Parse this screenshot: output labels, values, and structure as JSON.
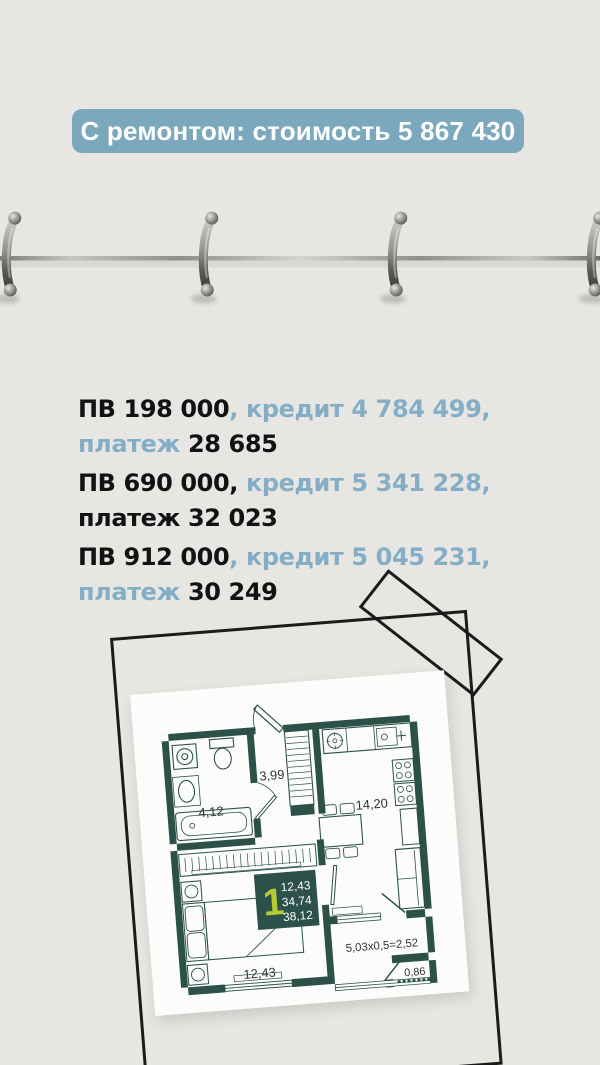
{
  "page": {
    "background": "#e8e6e2"
  },
  "header_badge": {
    "text": "С ремонтом: стоимость 5 867 430",
    "bg": "#7ca8bd",
    "text_color": "#ffffff"
  },
  "decor": {
    "binder_rings": 4,
    "frame": "hand-drawn-rectangle-outline",
    "tape": "diagonal-rectangle-outline"
  },
  "colors": {
    "accent_blue": "#84aec6",
    "text_dark": "#121212",
    "wall_teal": "#2b5148",
    "lime": "#b6cb33",
    "frame_black": "#1b1b1b"
  },
  "offers": [
    {
      "lines": [
        [
          {
            "text": "ПВ 198 000",
            "color": "dark"
          },
          {
            "text": ", ",
            "color": "blue"
          },
          {
            "text": "кредит 4 784 499,",
            "color": "blue"
          }
        ],
        [
          {
            "text": "платеж ",
            "color": "blue"
          },
          {
            "text": "28 685",
            "color": "dark"
          }
        ]
      ]
    },
    {
      "lines": [
        [
          {
            "text": "ПВ 690 000",
            "color": "dark"
          },
          {
            "text": ", ",
            "color": "dark"
          },
          {
            "text": "кредит 5 341 228,",
            "color": "blue"
          }
        ],
        [
          {
            "text": "платеж 32 023",
            "color": "dark"
          }
        ]
      ]
    },
    {
      "lines": [
        [
          {
            "text": "ПВ 912 000",
            "color": "dark"
          },
          {
            "text": ", ",
            "color": "blue"
          },
          {
            "text": "кредит 5 045 231,",
            "color": "blue"
          }
        ],
        [
          {
            "text": "платеж ",
            "color": "blue"
          },
          {
            "text": "30 249",
            "color": "dark"
          }
        ]
      ]
    }
  ],
  "floorplan": {
    "unit_badge": {
      "number": "1",
      "area_lines": [
        "12,43",
        "34,74",
        "38,12"
      ]
    },
    "labels": {
      "hallway": "3,99",
      "bathroom": "4,12",
      "kitchen_living": "14,20",
      "bedroom": "12,43",
      "balcony": "5,03x0,5=2,52",
      "balcony_small": "0,86"
    }
  }
}
